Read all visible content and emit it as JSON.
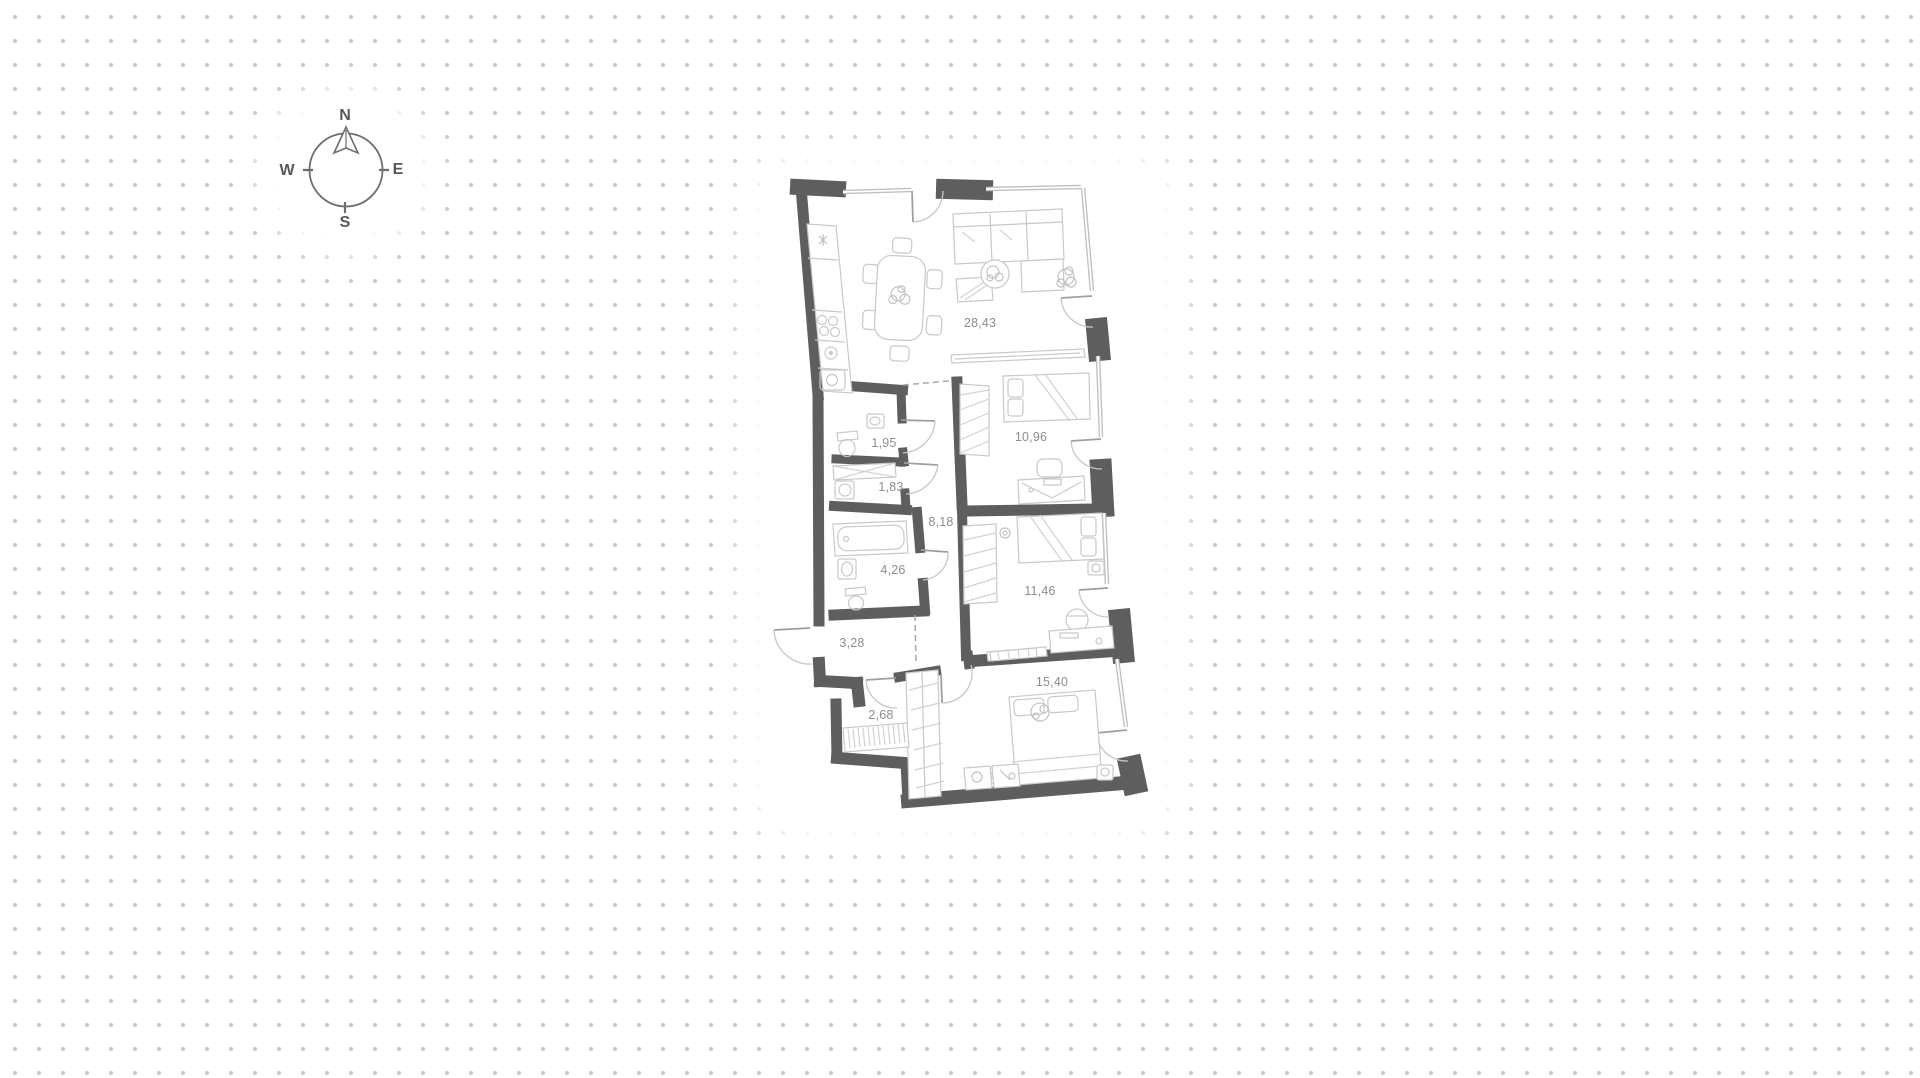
{
  "compass": {
    "north": "N",
    "east": "E",
    "south": "S",
    "west": "W"
  },
  "floor_plan": {
    "rooms": [
      {
        "id": "living-kitchen",
        "area_label": "28,43",
        "x": 980,
        "y": 323
      },
      {
        "id": "bedroom-1",
        "area_label": "10,96",
        "x": 1031,
        "y": 437
      },
      {
        "id": "wc",
        "area_label": "1,95",
        "x": 884,
        "y": 443
      },
      {
        "id": "laundry",
        "area_label": "1,83",
        "x": 891,
        "y": 487
      },
      {
        "id": "hallway",
        "area_label": "8,18",
        "x": 941,
        "y": 522
      },
      {
        "id": "bathroom",
        "area_label": "4,26",
        "x": 893,
        "y": 570
      },
      {
        "id": "bedroom-2",
        "area_label": "11,46",
        "x": 1040,
        "y": 591
      },
      {
        "id": "entry-hall",
        "area_label": "3,28",
        "x": 852,
        "y": 643
      },
      {
        "id": "closet",
        "area_label": "2,68",
        "x": 881,
        "y": 715
      },
      {
        "id": "bedroom-3",
        "area_label": "15,40",
        "x": 1052,
        "y": 682
      }
    ]
  },
  "colors": {
    "wall": "#5e5e5e",
    "thin_wall": "#c0c0c0",
    "furniture": "#c9c9c9",
    "label_text": "#8d8d8d",
    "dot_grid": "#cacaca"
  }
}
